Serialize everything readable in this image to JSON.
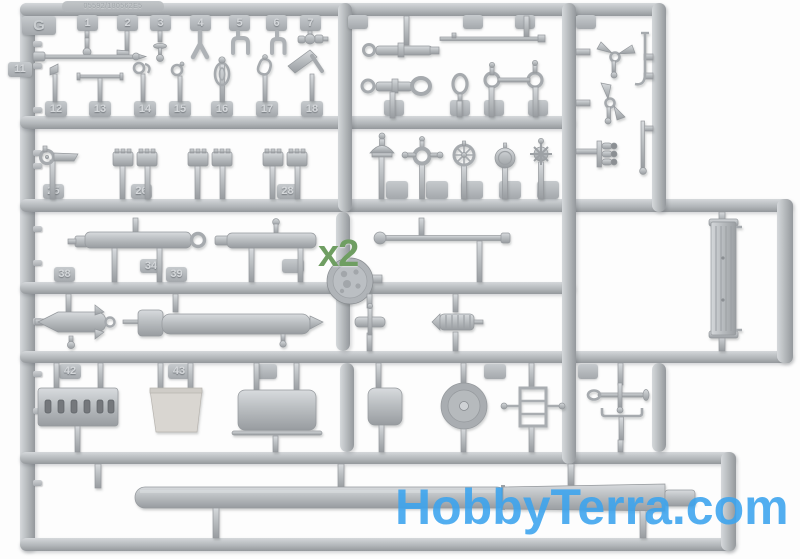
{
  "photo": {
    "sprue_letter": "G",
    "mold_code": "05592/180562E5",
    "multiplier_label": "x2",
    "watermark": "HobbyTerra.com",
    "colors": {
      "plastic_base": "#b5b9bd",
      "plastic_light": "#d6d9db",
      "plastic_dark": "#8f9397",
      "clip_dark": "#74787c",
      "bucket_beige": "#d9d6d1",
      "multiplier_green": "#6f9e62",
      "watermark_blue": "#3ba4ef",
      "background": "#ffffff"
    },
    "tabs": {
      "row1": [
        "1",
        "2",
        "3",
        "4",
        "5",
        "6",
        "7"
      ],
      "left_tab": "11",
      "row2": [
        "12",
        "13",
        "14",
        "15",
        "16",
        "17",
        "18"
      ],
      "row3": [
        "25",
        "26",
        "28"
      ],
      "mid_row": [
        "34",
        "38",
        "39"
      ],
      "row4": [
        "42",
        "43"
      ]
    }
  }
}
